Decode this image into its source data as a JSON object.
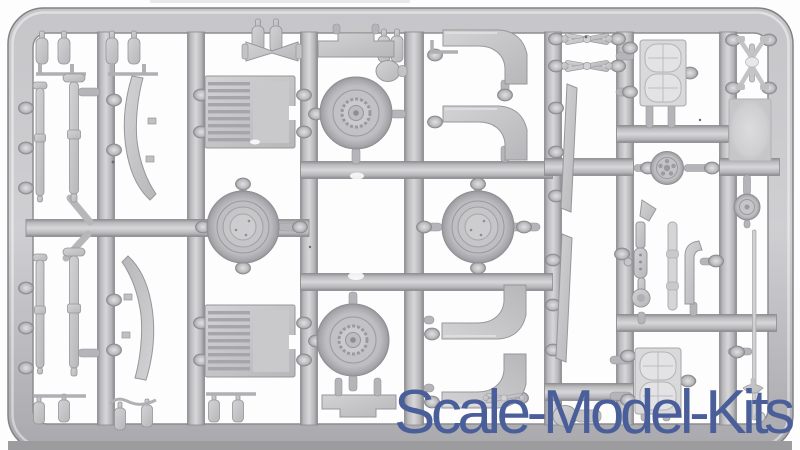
{
  "image": {
    "description": "Photograph of a light grey injection-moulded plastic model kit sprue (runner frame with attached parts) on a white background",
    "orientation": "landscape"
  },
  "watermark": {
    "text": "Scale-Model-Kits",
    "color": "#4a5f99"
  },
  "palette": {
    "background": "#fdfdfd",
    "plastic_mid": "#b9b9bc",
    "plastic_highlight": "#d6d6d8",
    "plastic_shadow": "#8e8e92",
    "part_light": "#dedee0",
    "bottom_edge_strip": "#9c9c9f",
    "watermark_blue": "#4a5f99"
  },
  "sprue": {
    "layout": "rectangular outer frame with 7 vertical runners and 8 horizontal runner segments",
    "parts": [
      {
        "name": "dished-road-wheel",
        "count": 2
      },
      {
        "name": "road-wheel-with-sprocket-hub",
        "count": 2
      },
      {
        "name": "curved-fender",
        "count": 4
      },
      {
        "name": "engine-grille-plate",
        "count": 2
      },
      {
        "name": "bench-seat-with-cushions",
        "count": 2
      },
      {
        "name": "leaf-spring-blade",
        "count": 2
      },
      {
        "name": "long-rod-with-collar",
        "count": 4
      },
      {
        "name": "small-cylinder-bottle",
        "count": 12
      },
      {
        "name": "wire-bracket",
        "count": 5
      },
      {
        "name": "tie-rod-cross-link",
        "count": 3
      },
      {
        "name": "bowtie-coupler",
        "count": 1
      },
      {
        "name": "bracket-plate",
        "count": 2
      },
      {
        "name": "machine-gun",
        "count": 1
      },
      {
        "name": "exhaust-pipe",
        "count": 1
      },
      {
        "name": "segmented-pipe",
        "count": 1
      },
      {
        "name": "small-spoked-wheel",
        "count": 1
      },
      {
        "name": "small-drum-wheel",
        "count": 1
      },
      {
        "name": "flat-panel",
        "count": 1
      },
      {
        "name": "mushroom-grip",
        "count": 2
      },
      {
        "name": "thin-blade",
        "count": 2
      },
      {
        "name": "towing-rod-with-ring",
        "count": 1
      },
      {
        "name": "steering-linkage",
        "count": 1
      }
    ]
  }
}
